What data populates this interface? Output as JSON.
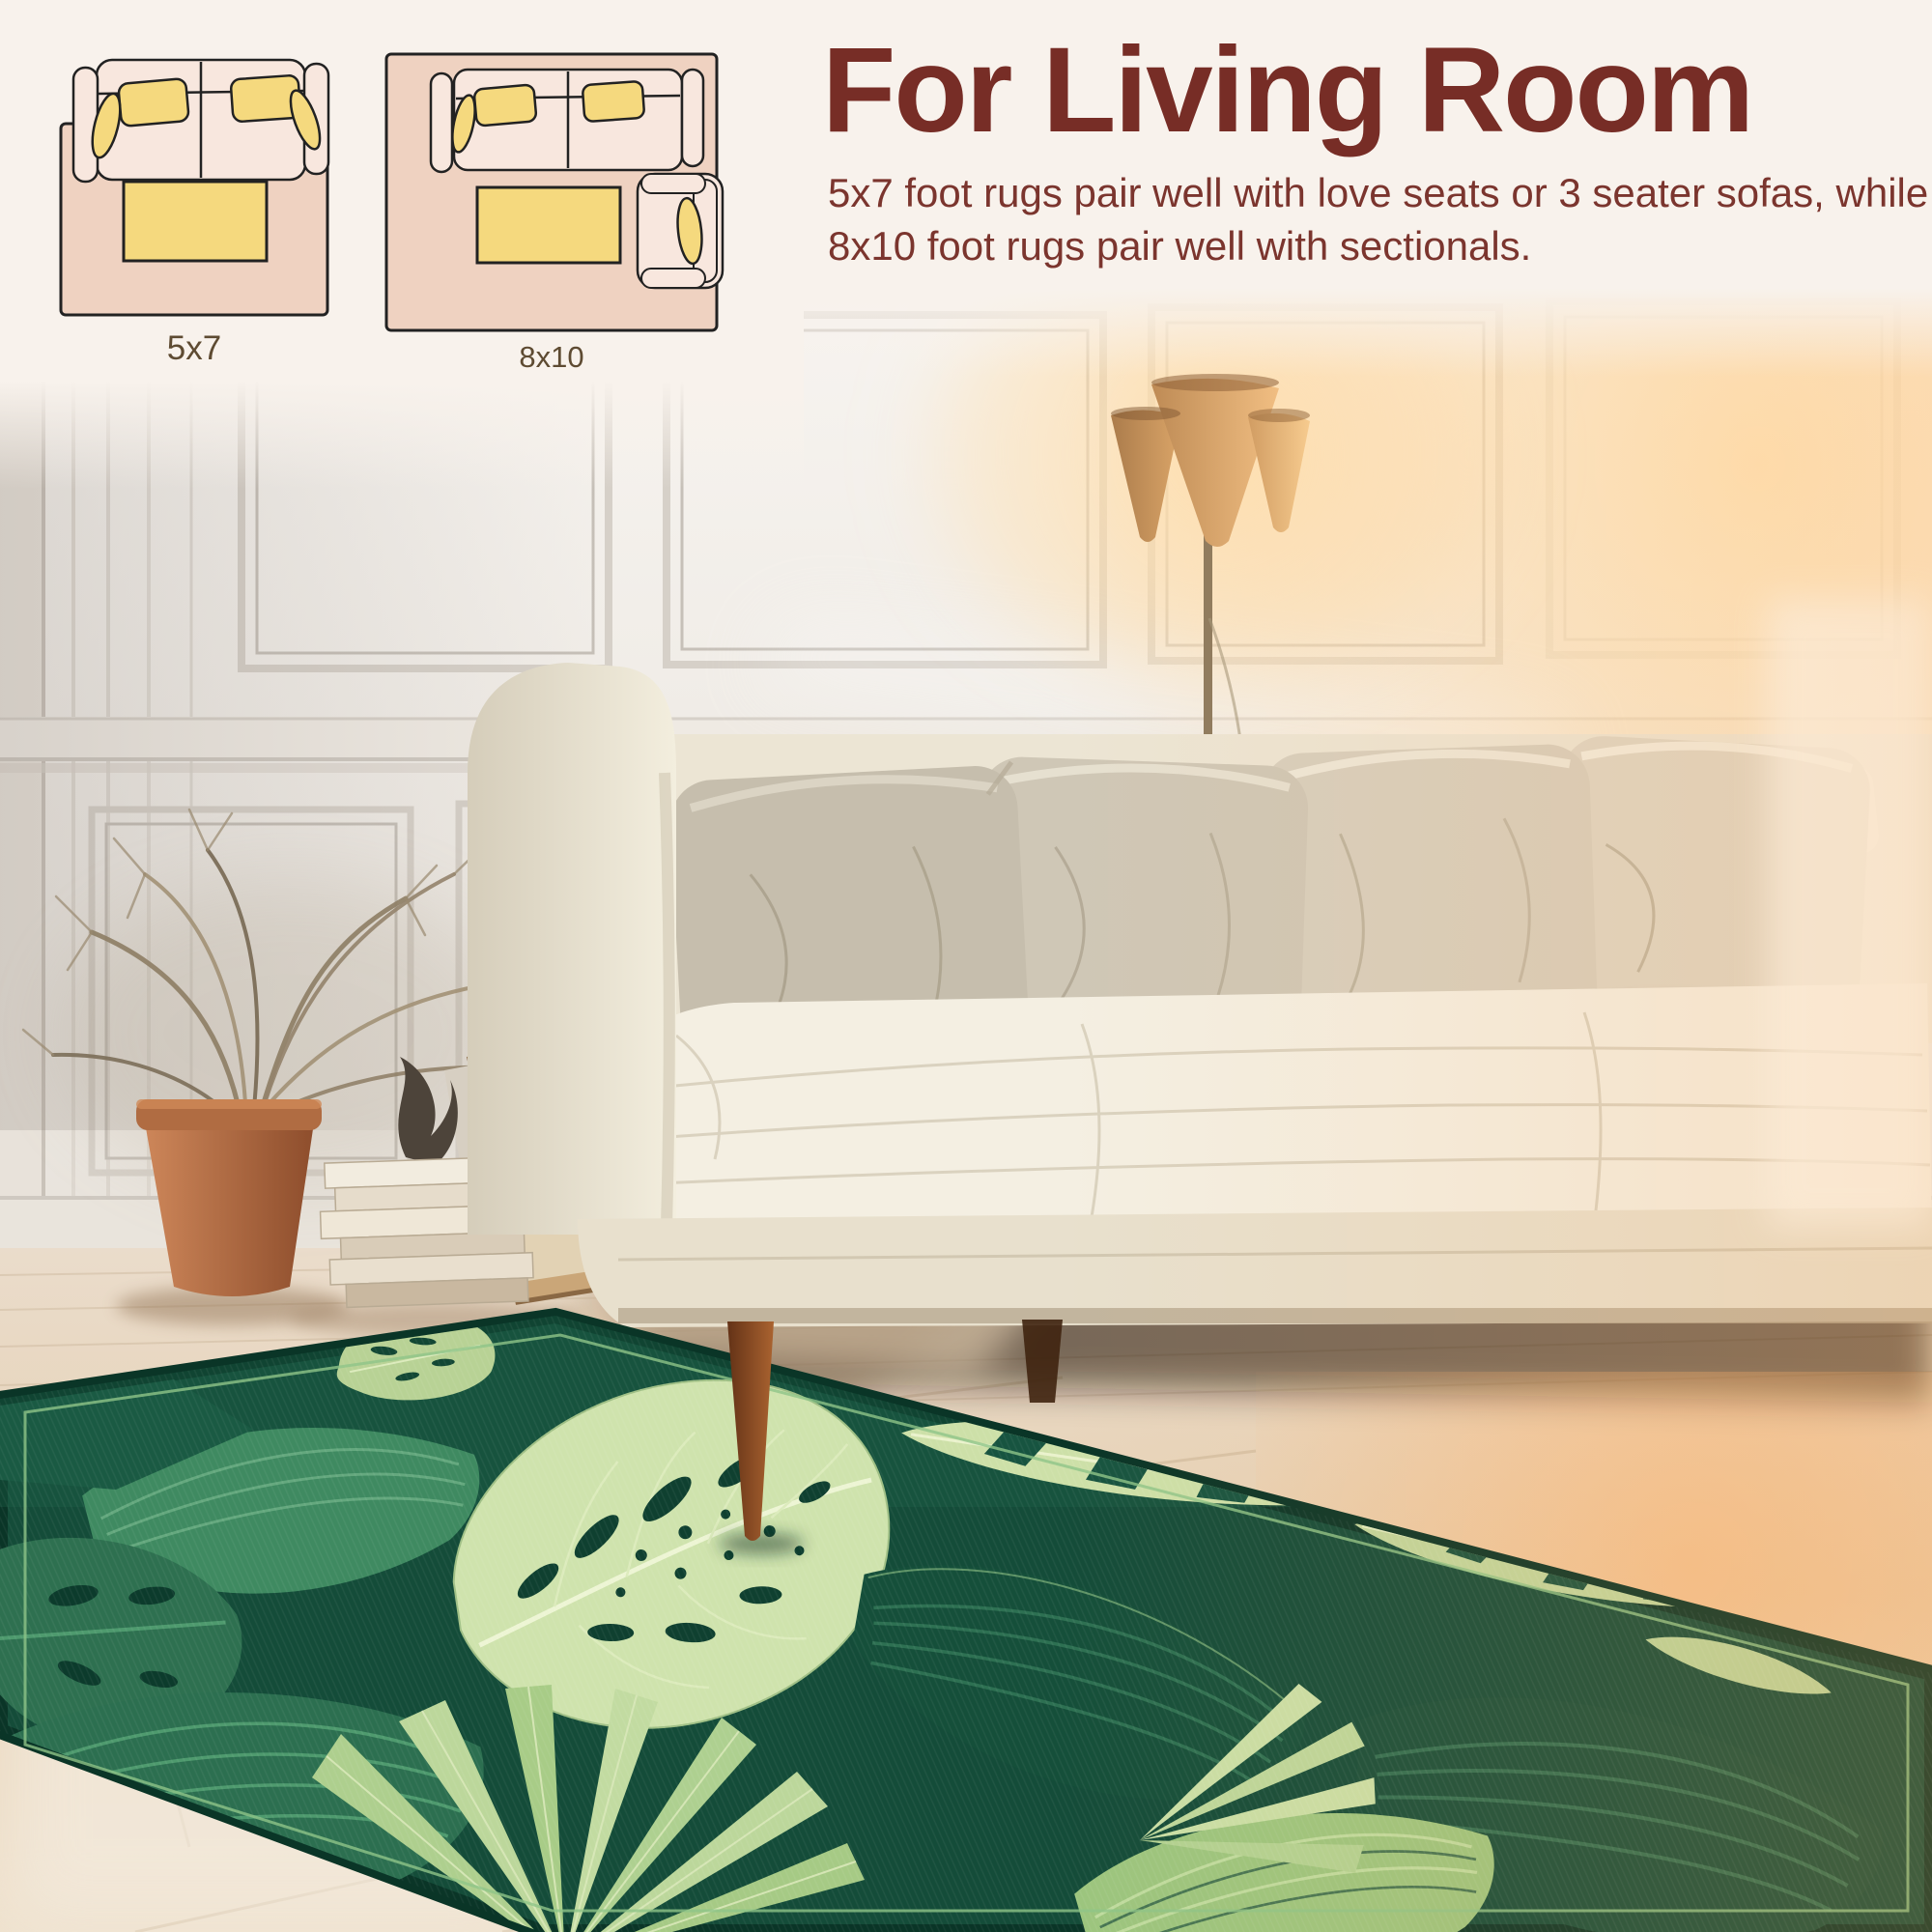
{
  "header": {
    "title": "For Living Room",
    "description": "5x7 foot rugs pair well with love seats or 3 seater sofas, while 8x10 foot rugs pair well with sectionals."
  },
  "diagrams": [
    {
      "label": "5x7",
      "contents": [
        "loveseat-top-view",
        "coffee-table",
        "rug-outline"
      ]
    },
    {
      "label": "8x10",
      "contents": [
        "sofa-top-view",
        "coffee-table",
        "armchair-top-view",
        "rug-outline"
      ]
    }
  ],
  "scene": {
    "objects": [
      "paneled-wall",
      "floor-lamp",
      "dried-palm-plant",
      "terracotta-pot",
      "book-stack",
      "leaning-picture-frames",
      "decor-vase",
      "white-sofa",
      "throw-pillows",
      "wood-plank-floor",
      "tropical-leaf-rug"
    ]
  },
  "colors": {
    "band_bg": "#F8F2EC",
    "heading_maroon": "#772D26",
    "body_maroon": "#7B352E",
    "label_brown": "#5E4B32",
    "diagram_rug_pink": "#EFD2C1",
    "diagram_sofa_pink": "#F8E7DE",
    "diagram_pillow_yellow": "#F5D97E",
    "diagram_outline": "#222222",
    "rug_dark_green": "#144C39",
    "rug_light_green": "#CFE3AD"
  }
}
